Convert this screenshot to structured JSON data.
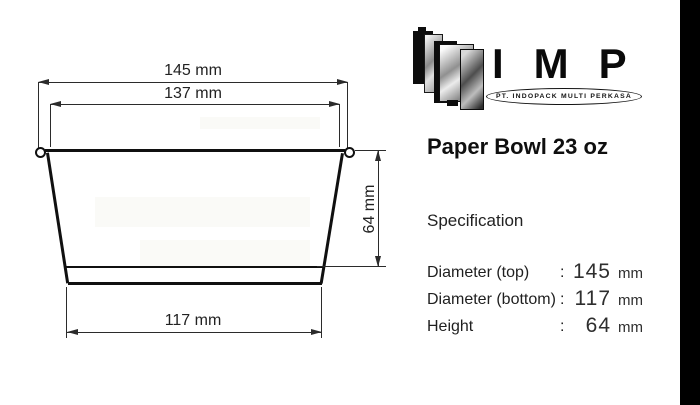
{
  "brand": {
    "wordmark": "IMP",
    "company": "PT. INDOPACK MULTI PERKASA"
  },
  "product": {
    "title": "Paper Bowl 23 oz",
    "section_heading": "Specification"
  },
  "specs": [
    {
      "label": "Diameter (top)",
      "colon": ":",
      "value": "145",
      "unit": "mm"
    },
    {
      "label": "Diameter (bottom)",
      "colon": ":",
      "value": "117",
      "unit": "mm"
    },
    {
      "label": "Height",
      "colon": ":",
      "value": "64",
      "unit": "mm"
    }
  ],
  "drawing": {
    "dim_top_outer": "145 mm",
    "dim_top_inner": "137 mm",
    "dim_bottom": "117 mm",
    "dim_height": "64 mm"
  },
  "colors": {
    "ink": "#1a1a1a",
    "line": "#2b2b2b",
    "bar": "#000000",
    "background": "#ffffff"
  }
}
